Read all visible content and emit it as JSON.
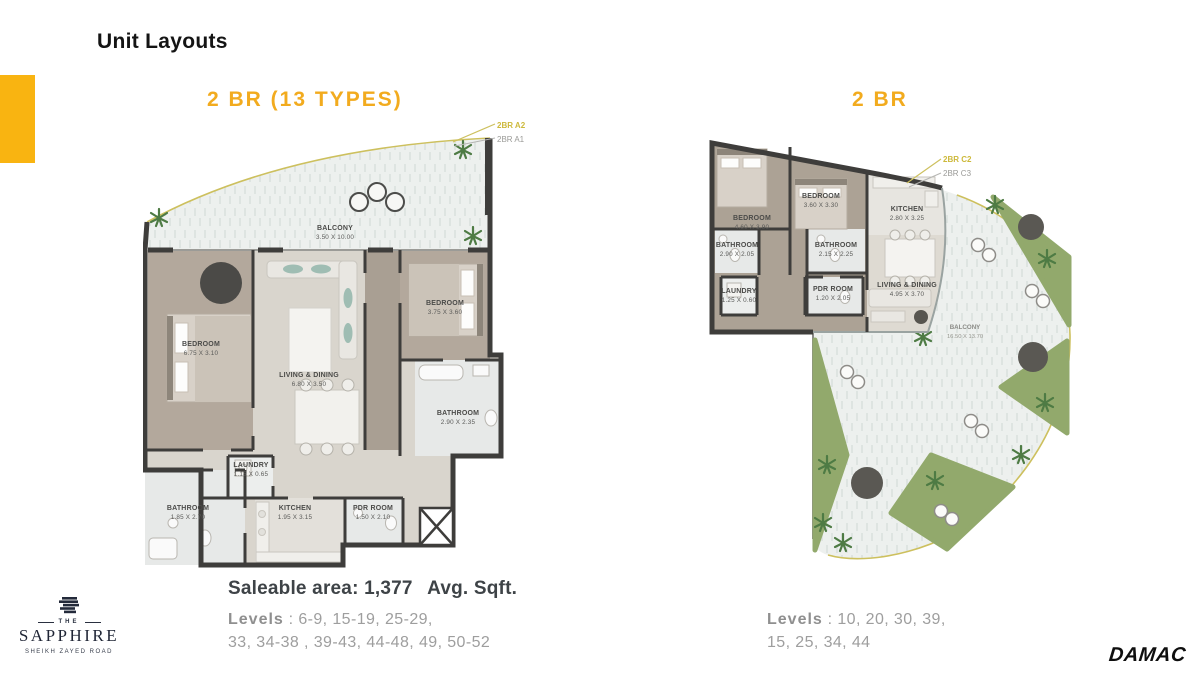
{
  "header": {
    "title": "Unit Layouts"
  },
  "colors": {
    "accent_yellow": "#F9B411",
    "heading_yellow": "#F2AB1E",
    "tag_yellow": "#CDB93B",
    "wall_dark": "#3E3D3B",
    "grass_green": "#92A96C",
    "floor_taupe": "#B3A89C",
    "logo_navy": "#1F2535"
  },
  "plans": {
    "left": {
      "heading": "2 BR (13 TYPES)",
      "tags": {
        "primary": "2BR A2",
        "secondary": "2BR A1"
      },
      "rooms": {
        "balcony": {
          "name": "BALCONY",
          "dims": "3.50 X 10.00"
        },
        "bedroom1": {
          "name": "BEDROOM",
          "dims": "6.75 X 3.10"
        },
        "living": {
          "name": "LIVING & DINING",
          "dims": "6.80 X 3.50"
        },
        "bedroom2": {
          "name": "BEDROOM",
          "dims": "3.75 X 3.60"
        },
        "bathroom1": {
          "name": "BATHROOM",
          "dims": "2.90 X 2.35"
        },
        "bathroom2": {
          "name": "BATHROOM",
          "dims": "1.85 X 2.70"
        },
        "laundry": {
          "name": "LAUNDRY",
          "dims": "1.15 X 0.65"
        },
        "kitchen": {
          "name": "KITCHEN",
          "dims": "1.95 X 3.15"
        },
        "pdr": {
          "name": "PDR ROOM",
          "dims": "1.50 X 2.10"
        }
      },
      "saleable": {
        "label": "Saleable area:",
        "value": "1,377",
        "unit": "Avg. Sqft."
      },
      "levels": {
        "label": "Levels",
        "line1": ": 6-9, 15-19, 25-29,",
        "line2": "33, 34-38 , 39-43, 44-48, 49, 50-52"
      }
    },
    "right": {
      "heading": "2 BR",
      "tags": {
        "primary": "2BR C2",
        "secondary": "2BR C3"
      },
      "rooms": {
        "bedroom1": {
          "name": "BEDROOM",
          "dims": "4.60 X 3.90"
        },
        "bedroom2": {
          "name": "BEDROOM",
          "dims": "3.60 X 3.30"
        },
        "bathroom1": {
          "name": "BATHROOM",
          "dims": "2.90 X 2.05"
        },
        "bathroom2": {
          "name": "BATHROOM",
          "dims": "2.15 X 2.25"
        },
        "laundry": {
          "name": "LAUNDRY",
          "dims": "1.25 X 0.60"
        },
        "pdr": {
          "name": "PDR ROOM",
          "dims": "1.20 X 2.05"
        },
        "kitchen": {
          "name": "KITCHEN",
          "dims": "2.80 X 3.25"
        },
        "living": {
          "name": "LIVING & DINING",
          "dims": "4.95 X 3.70"
        },
        "balcony": {
          "name": "BALCONY",
          "dims": "16.50 X 13.70"
        }
      },
      "levels": {
        "label": "Levels",
        "line1": ": 10, 20, 30, 39,",
        "line2": "15, 25, 34, 44"
      }
    }
  },
  "footer": {
    "sapphire": {
      "the": "THE",
      "name": "SAPPHIRE",
      "tagline": "SHEIKH ZAYED ROAD"
    },
    "damac": "DAMAC"
  }
}
